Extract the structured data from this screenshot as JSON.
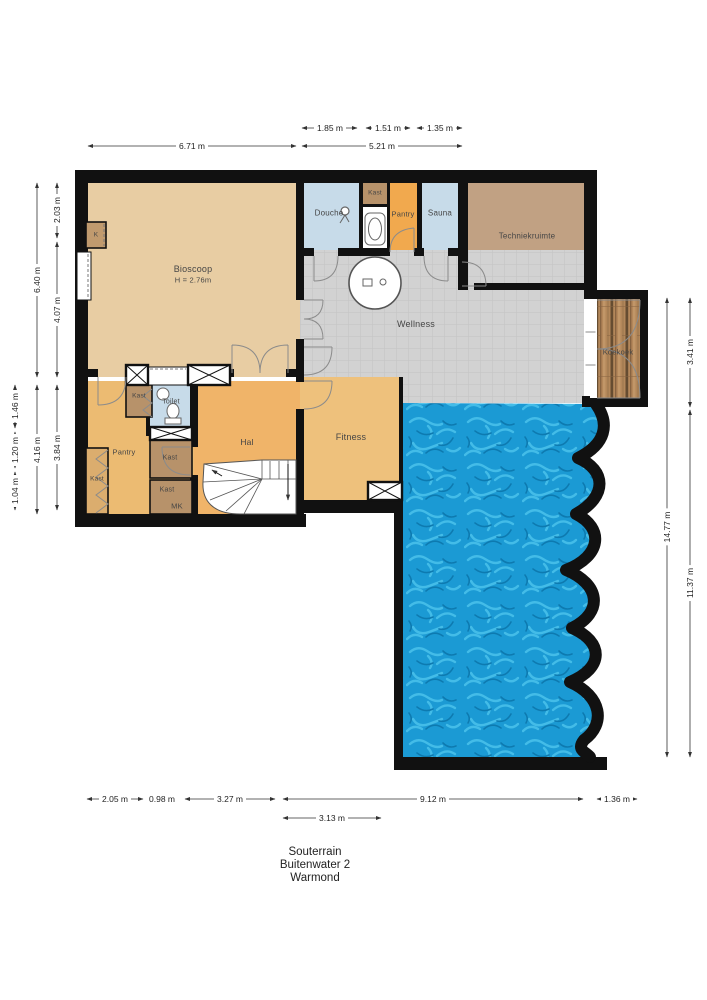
{
  "title": {
    "line1": "Souterrain",
    "line2": "Buitenwater 2",
    "line3": "Warmond"
  },
  "rooms": {
    "bioscoop": "Bioscoop",
    "bioscoop_height": "H = 2.76m",
    "douche": "Douche",
    "kast_top": "Kast",
    "pantry_top": "Pantry",
    "sauna": "Sauna",
    "techniekruimte": "Techniekruimte",
    "wellness": "Wellness",
    "koekoek": "Koekoek",
    "fitness": "Fitness",
    "hal": "Hal",
    "toilet": "Toilet",
    "pantry": "Pantry",
    "kast_left": "Kast",
    "kast_hall": "Kast",
    "kast_mid": "Kast",
    "kast_bottom": "Kast",
    "mk": "MK",
    "k": "K"
  },
  "dimensions": {
    "top_inner": [
      "1.85 m",
      "1.51 m",
      "1.35 m"
    ],
    "top_outer": [
      "6.71 m",
      "5.21 m"
    ],
    "left_inner": [
      "2.03 m",
      "4.07 m",
      "3.84 m"
    ],
    "left_mid": [
      "6.40 m",
      "4.16 m"
    ],
    "left_outer": [
      "1.46 m",
      "1.20 m",
      "1.04 m"
    ],
    "right_inner": "14.77 m",
    "right_outer": [
      "3.41 m",
      "11.37 m"
    ],
    "bottom": [
      "2.05 m",
      "0.98 m",
      "3.27 m",
      "9.12 m",
      "1.36 m"
    ],
    "bottom_inner": "3.13 m"
  },
  "colors": {
    "wall": "#111111",
    "bioscoop": "#e8cda3",
    "hall_orange": "#f0b469",
    "pantry_orange": "#f1a94e",
    "closet_brown": "#b7926a",
    "tech_brown": "#c1a183",
    "wet_blue": "#c7dbe9",
    "wellness_gray": "#d2d2d2",
    "pool_water": "#1b9ad4",
    "wood": "#b3875a"
  }
}
